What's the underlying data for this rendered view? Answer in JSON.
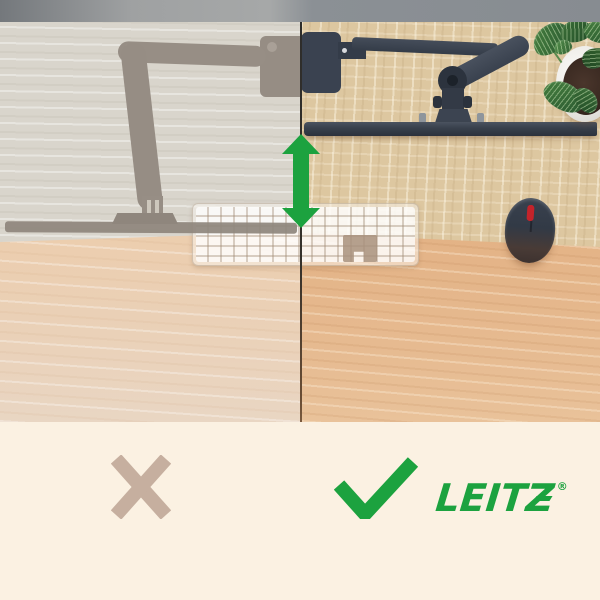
{
  "page": {
    "type": "product-comparison-graphic"
  },
  "brand": {
    "name": "LEITZ",
    "registered_mark": "®",
    "color": "#1ca23f"
  },
  "comparison": {
    "wrong": {
      "icon": "x-mark",
      "color": "#c6af9f",
      "panel": "left",
      "style": "faded-silhouette"
    },
    "correct": {
      "icon": "check-mark",
      "color": "#1ca23f",
      "panel": "right",
      "style": "vivid"
    }
  },
  "annotation": {
    "icon": "double-vertical-arrow",
    "meaning": "height-adjustable monitor arm",
    "color": "#1ca23f"
  },
  "scene": {
    "objects": [
      "monitor-arm-with-screen",
      "keyboard",
      "mouse",
      "potted-plant",
      "desk"
    ],
    "colors": {
      "wall_bar": "#8c9195",
      "desk_upper_left": "#d9d5cc",
      "desk_upper_right": "#ddc7a0",
      "desk_lower_left": "#ecd1b6",
      "desk_lower_right": "#e5b78c",
      "monitor_navy": "#39414e",
      "faded_silhouette": "#978e85",
      "cream_panel": "#fbf1e2"
    }
  }
}
